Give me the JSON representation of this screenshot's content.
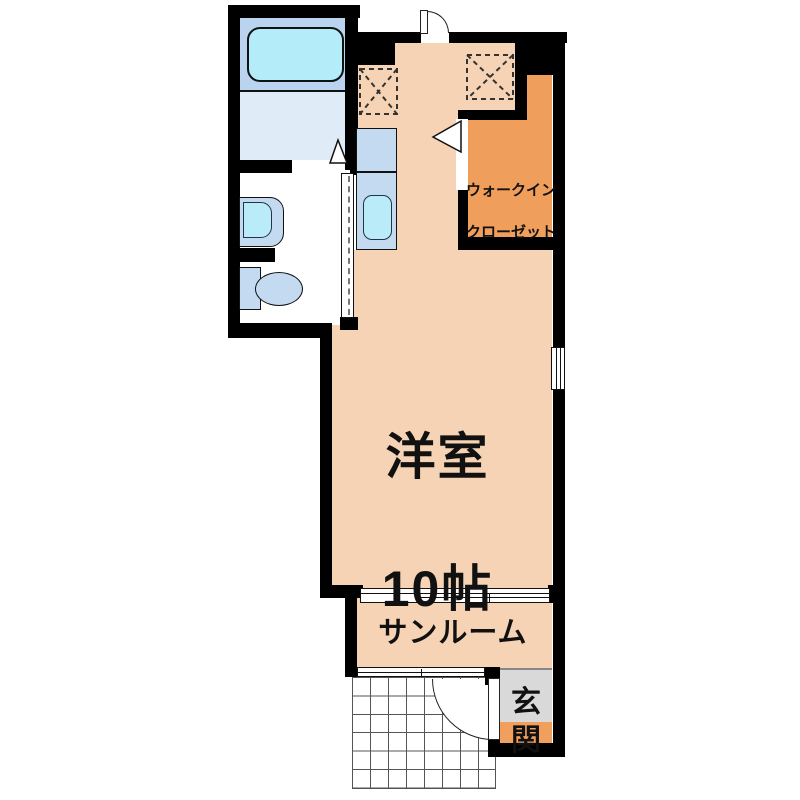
{
  "plan": {
    "type": "apartment-floor-plan",
    "labels": {
      "main_room_name": "洋室",
      "main_room_size": "10帖",
      "closet_line1": "ウォークイン",
      "closet_line2": "クローゼット",
      "sunroom": "サンルーム",
      "entrance": "玄関"
    },
    "rooms": [
      {
        "name": "western-room",
        "label": "洋室 10帖"
      },
      {
        "name": "walk-in-closet",
        "label": "ウォークインクローゼット"
      },
      {
        "name": "sunroom",
        "label": "サンルーム"
      },
      {
        "name": "entrance",
        "label": "玄関"
      },
      {
        "name": "bathroom",
        "label": ""
      },
      {
        "name": "washroom-toilet",
        "label": ""
      }
    ],
    "colors": {
      "room_floor": "#f5d3b4",
      "closet_floor": "#f09e5b",
      "entrance_step": "#f0a05c",
      "entrance_floor": "#d9d9d9",
      "bathroom_floor": "#bad3ee",
      "bathroom_washarea": "#e0ebf8",
      "bathtub": "#b4ecf9",
      "fixture_blue": "#c3daf1",
      "fixture_cyan": "#b9ebf8",
      "wall": "#000000",
      "background": "#ffffff"
    }
  }
}
